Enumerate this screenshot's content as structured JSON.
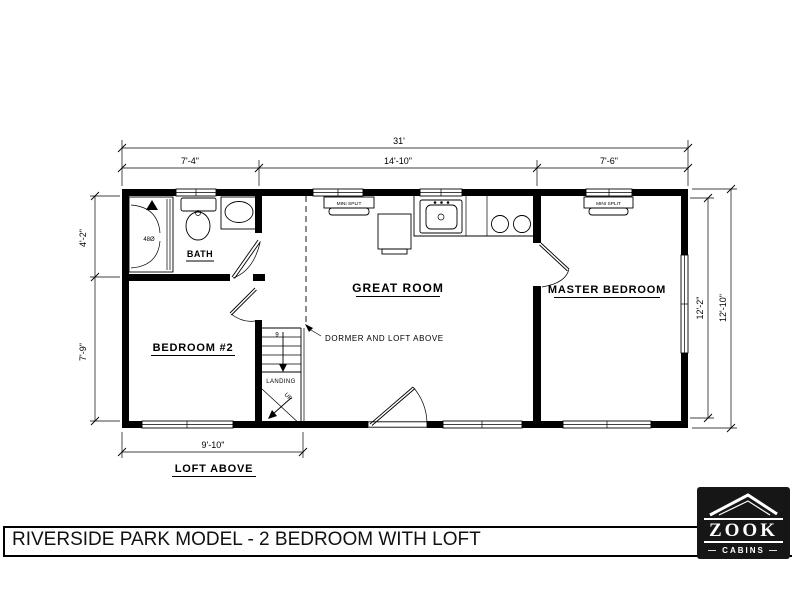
{
  "title": "RIVERSIDE PARK MODEL - 2 BEDROOM WITH LOFT",
  "rooms": {
    "bath": "BATH",
    "bedroom2": "BEDROOM #2",
    "great_room": "GREAT ROOM",
    "master_bedroom": "MASTER BEDROOM"
  },
  "dimensions": {
    "overall_width": "31'",
    "top_left": "7'-4\"",
    "top_middle": "14'-10\"",
    "top_right": "7'-6\"",
    "left_upper": "4'-2\"",
    "left_lower": "7'-9\"",
    "right_inner": "12'-2\"",
    "right_outer": "12'-10\"",
    "bottom_left": "9'-10\""
  },
  "annotations": {
    "dormer": "DORMER AND LOFT ABOVE",
    "landing": "LANDING",
    "loft_above": "LOFT ABOVE",
    "shower_size": "48Ø",
    "stair_up": "UP",
    "stair_risers": "9"
  },
  "equipment": {
    "mini_split": "MINI SPLIT"
  },
  "logo": {
    "name": "ZOOK",
    "subtitle": "— CABINS —"
  },
  "colors": {
    "wall": "#000000",
    "background": "#ffffff",
    "logo_background": "#161616"
  }
}
